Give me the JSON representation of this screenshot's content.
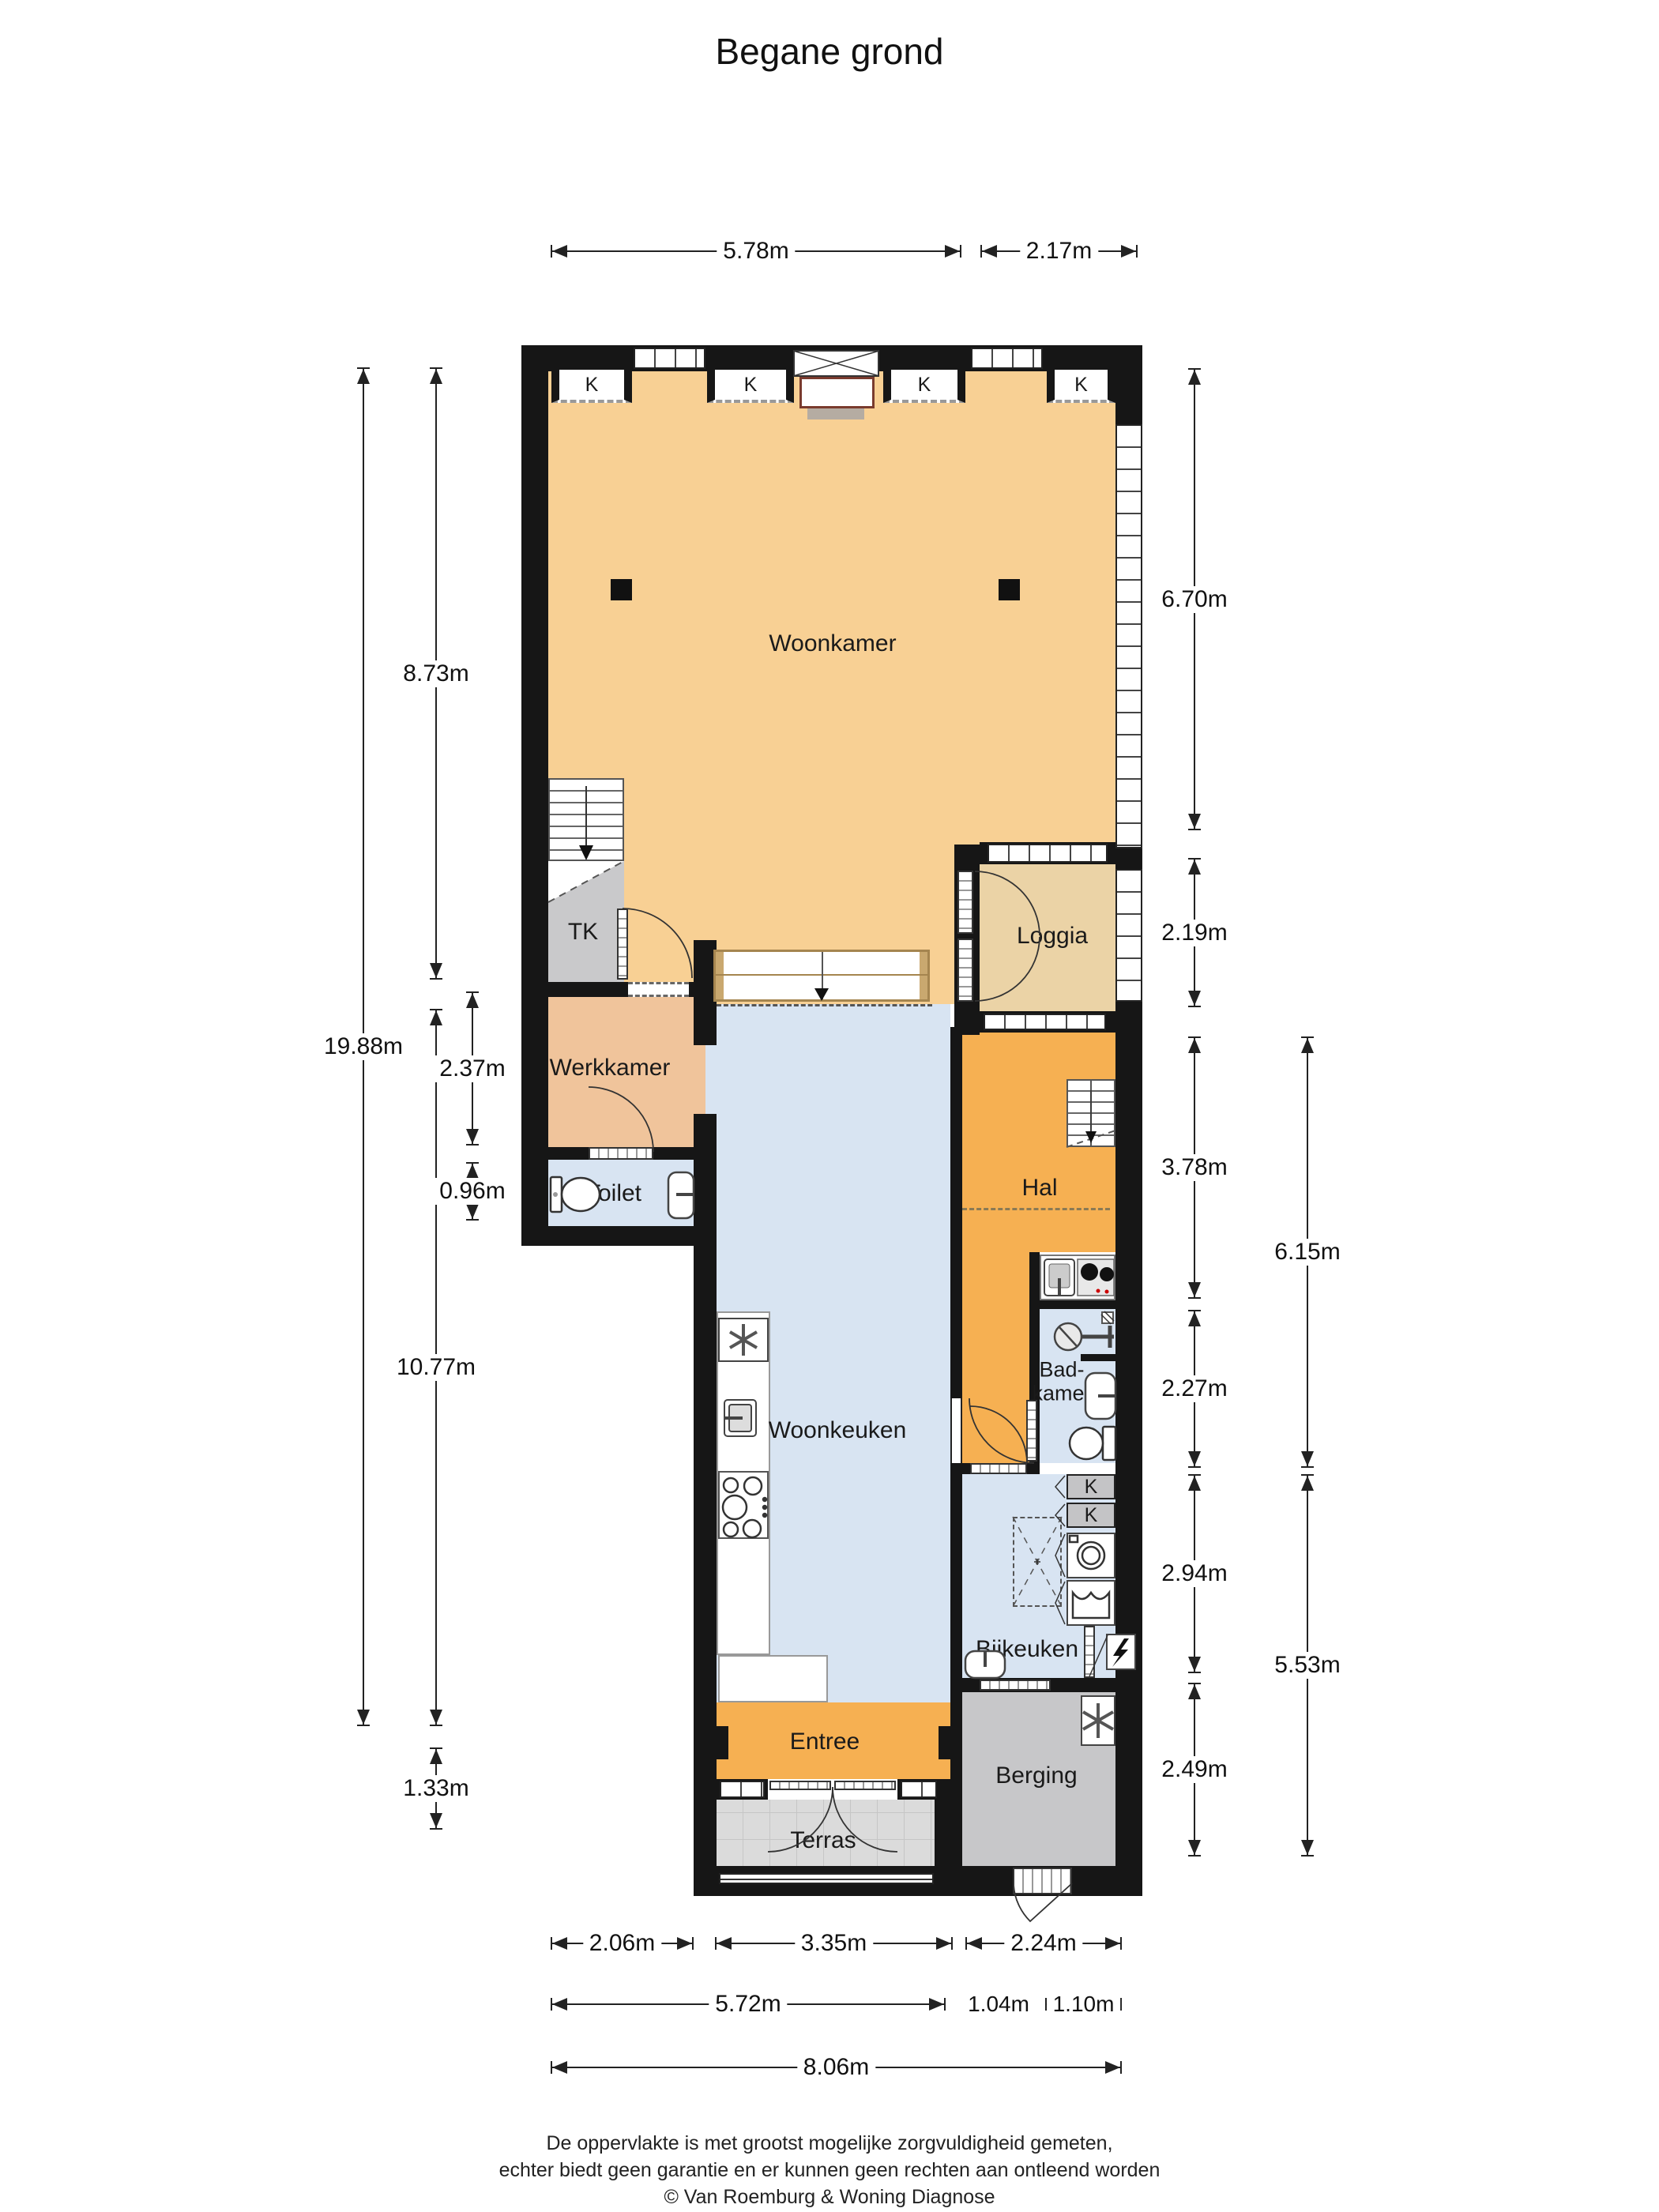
{
  "title": "Begane grond",
  "rooms": {
    "woonkamer": "Woonkamer",
    "tk": "TK",
    "werkkamer": "Werkkamer",
    "toilet": "Toilet",
    "loggia": "Loggia",
    "hal": "Hal",
    "woonkeuken": "Woonkeuken",
    "badkamer_line1": "Bad-",
    "badkamer_line2": "kamer",
    "bijkeuken": "Bijkeuken",
    "entree": "Entree",
    "terras": "Terras",
    "berging": "Berging",
    "closet": "K"
  },
  "dimensions": {
    "top": [
      "5.78m",
      "2.17m"
    ],
    "left_outer": [
      "19.88m"
    ],
    "left_inner": [
      "8.73m",
      "10.77m",
      "1.33m"
    ],
    "left_rooms": [
      "2.37m",
      "0.96m"
    ],
    "right_inner": [
      "6.70m",
      "2.19m",
      "3.78m",
      "2.27m",
      "2.94m",
      "2.49m"
    ],
    "right_outer": [
      "6.15m",
      "5.53m"
    ],
    "bottom_row1": [
      "2.06m",
      "3.35m",
      "2.24m"
    ],
    "bottom_row2": [
      "5.72m",
      "1.04m",
      "1.10m"
    ],
    "bottom_row3": [
      "8.06m"
    ]
  },
  "icons": {
    "fridge-icon": "asterisk-star",
    "freezer-icon": "asterisk-star",
    "stove-icon": "burner-circles",
    "sink-icon": "basin-with-faucet",
    "toilet-icon": "cistern-and-bowl",
    "shower-icon": "circle-with-arm",
    "washer-icon": "square-with-circle",
    "dryer-icon": "square-with-wave",
    "electric-panel-icon": "lightning-bolt",
    "stair-arrow-icon": "down-arrow",
    "sofa-arrow-icon": "down-arrow"
  },
  "footer": {
    "line1": "De oppervlakte is met grootst mogelijke zorgvuldigheid gemeten,",
    "line2": "echter biedt geen garantie en er kunnen geen rechten aan ontleend worden",
    "line3": "© Van Roemburg & Woning Diagnose"
  },
  "colors": {
    "wall": "#161616",
    "woonkamer": "#F8D094",
    "hal_entree": "#F6B052",
    "loggia": "#EBD3A6",
    "werkkamer": "#F0C49B",
    "wet_rooms": "#D8E4F2",
    "storage_gray": "#C9C9CB",
    "terras": "#DBDBDB",
    "sofa_trim": "#A5854F"
  }
}
